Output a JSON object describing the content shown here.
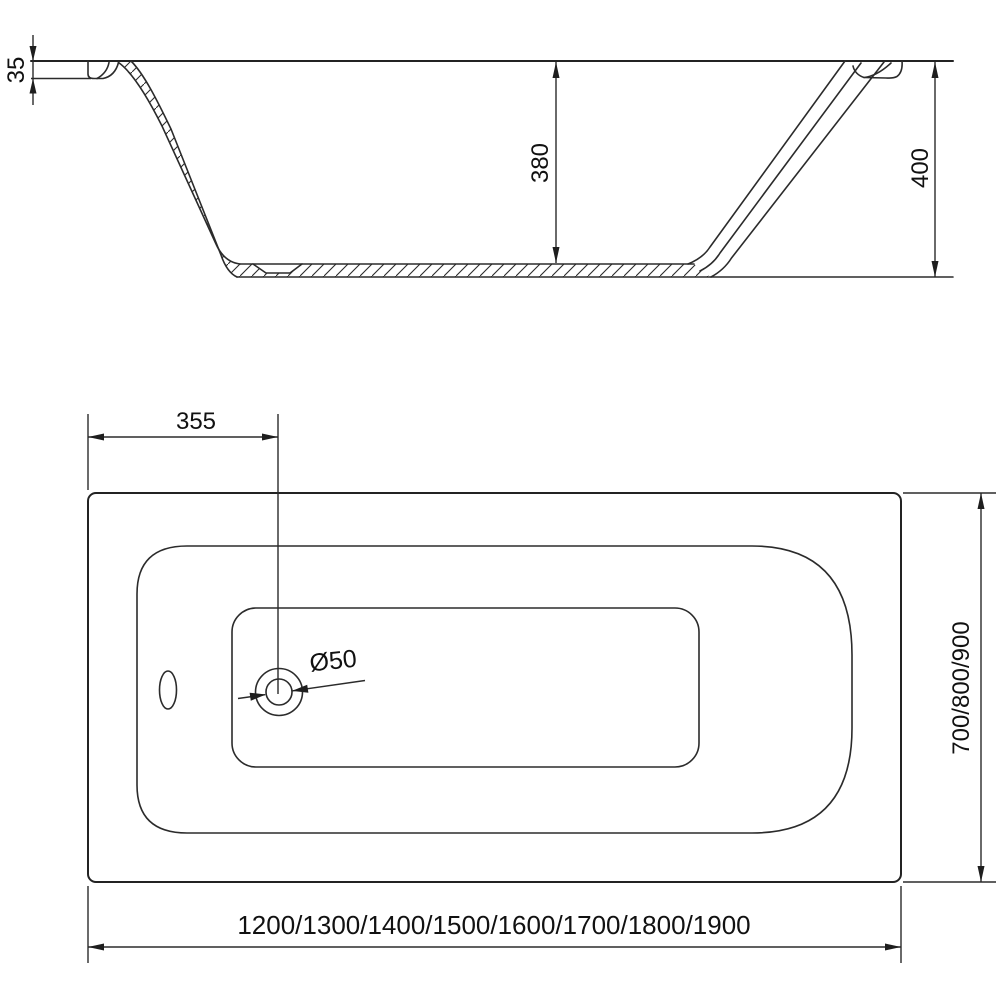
{
  "side_view": {
    "rim_thickness": "35",
    "inner_depth": "380",
    "overall_height": "400"
  },
  "top_view": {
    "drain_offset": "355",
    "drain_diameter": "Ø50",
    "width_options": "700/800/900",
    "length_options": "1200/1300/1400/1500/1600/1700/1800/1900"
  }
}
